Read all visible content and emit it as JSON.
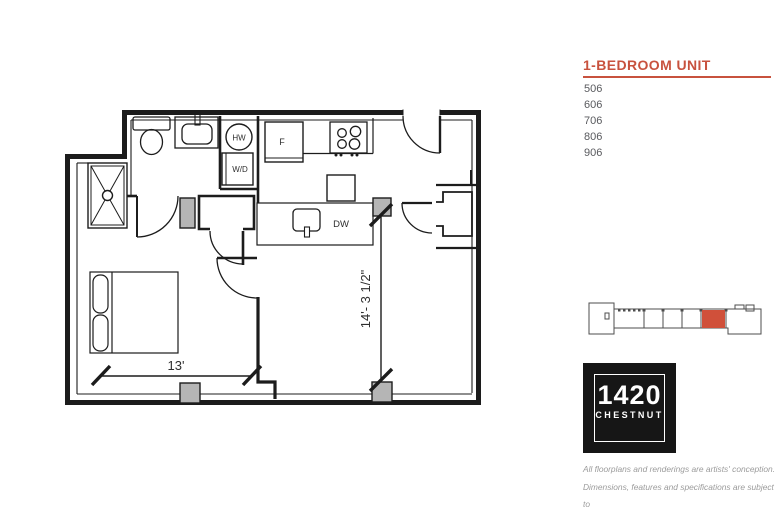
{
  "colors": {
    "accent": "#c8523e",
    "unit_highlight": "#d0503a",
    "wall": "#1c1c1c",
    "post_gray": "#b5b5b5",
    "unit_text_gray": "#595a5e",
    "disclaimer_gray": "#9b9b9b"
  },
  "sidebar": {
    "title": "1-BEDROOM UNIT",
    "units": [
      "506",
      "606",
      "706",
      "806",
      "906"
    ],
    "logo": {
      "number": "1420",
      "name": "CHESTNUT"
    },
    "disclaimer_lines": [
      "All floorplans and renderings are artists' conception.",
      "Dimensions, features and specifications are subject to",
      "change at the discretion of the builder."
    ]
  },
  "floorplan": {
    "labels": {
      "fridge": "F",
      "hot_water": "HW",
      "washer_dryer": "W/D",
      "dishwasher": "DW"
    },
    "dimensions": {
      "width_label": "13'",
      "height_label": "14'- 3 1/2\""
    }
  }
}
